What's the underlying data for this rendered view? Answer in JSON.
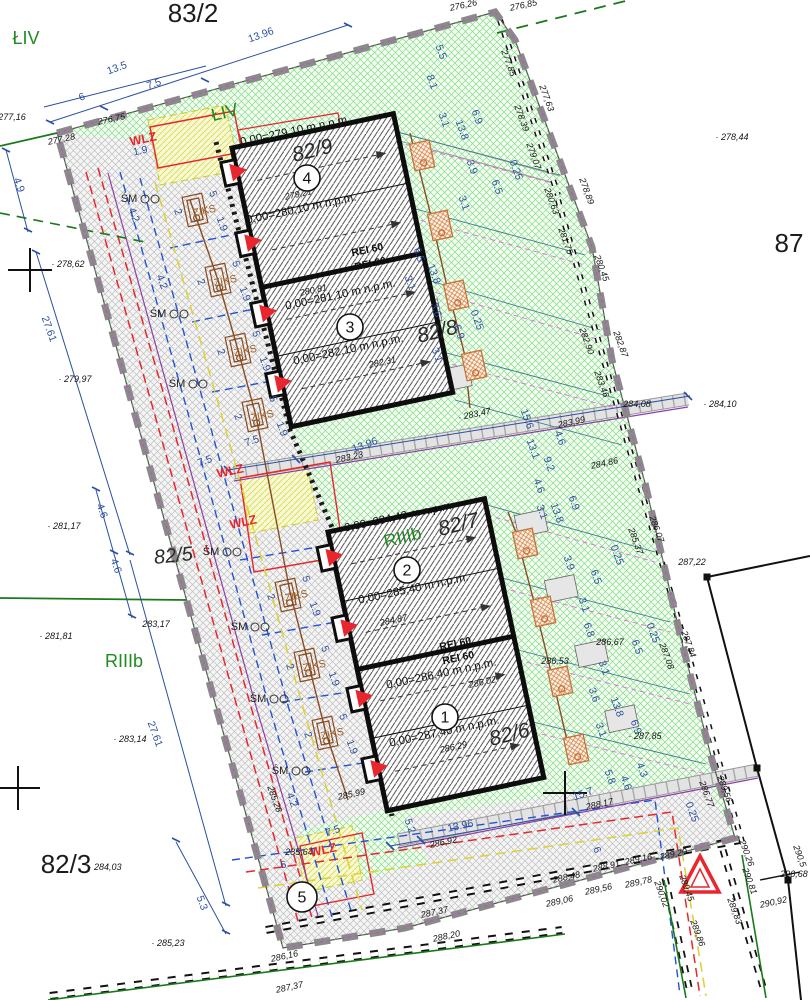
{
  "drawing_type": "site development plan",
  "parcels": [
    {
      "label": "83/2",
      "x": 193,
      "y": 22,
      "rot": 0,
      "size": 26,
      "it": false
    },
    {
      "label": "82/9",
      "x": 314,
      "y": 157,
      "rot": -14,
      "size": 21,
      "it": true
    },
    {
      "label": "82/8",
      "x": 439,
      "y": 338,
      "rot": -14,
      "size": 21,
      "it": true
    },
    {
      "label": "87",
      "x": 789,
      "y": 252,
      "rot": 0,
      "size": 26,
      "it": false
    },
    {
      "label": "82/7",
      "x": 460,
      "y": 531,
      "rot": -14,
      "size": 21,
      "it": true
    },
    {
      "label": "82/6",
      "x": 511,
      "y": 741,
      "rot": -14,
      "size": 21,
      "it": true
    },
    {
      "label": "82/5",
      "x": 174,
      "y": 562,
      "rot": -6,
      "size": 20,
      "it": true
    },
    {
      "label": "82/3",
      "x": 66,
      "y": 873,
      "rot": 0,
      "size": 26,
      "it": false
    }
  ],
  "soil": [
    {
      "t": "ŁIV",
      "x": 26,
      "y": 44,
      "rot": 0
    },
    {
      "t": "ŁIV",
      "x": 226,
      "y": 118,
      "rot": -14
    },
    {
      "t": "RIIIb",
      "x": 124,
      "y": 667,
      "rot": 0
    },
    {
      "t": "RIIIb",
      "x": 404,
      "y": 543,
      "rot": -14
    }
  ],
  "building_numbers": [
    {
      "n": "4",
      "x": 307,
      "y": 178
    },
    {
      "n": "3",
      "x": 350,
      "y": 327
    },
    {
      "n": "2",
      "x": 407,
      "y": 570
    },
    {
      "n": "1",
      "x": 445,
      "y": 717
    },
    {
      "n": "5",
      "x": 302,
      "y": 897
    }
  ],
  "levels": [
    {
      "t": "0,00=279,10 m n.p.m.",
      "x": 296,
      "y": 134,
      "rot": -12
    },
    {
      "t": "0,00=280,10 m n.p.m.",
      "x": 302,
      "y": 212,
      "rot": -12
    },
    {
      "t": "0,00=281,10 m n.p.m.",
      "x": 341,
      "y": 298,
      "rot": -12
    },
    {
      "t": "0,00=282,10 m n.p.m.",
      "x": 349,
      "y": 353,
      "rot": -12
    },
    {
      "t": "0,00=284,40 m n.p.m.",
      "x": 400,
      "y": 520,
      "rot": -12
    },
    {
      "t": "0,00=285,40 m n.p.m.",
      "x": 414,
      "y": 592,
      "rot": -12
    },
    {
      "t": "0,00=286,40 m n.p.m.",
      "x": 442,
      "y": 677,
      "rot": -12
    },
    {
      "t": "0,00=287,40 m n.p.m.",
      "x": 445,
      "y": 735,
      "rot": -12
    }
  ],
  "fire_walls": [
    {
      "t": "REI 60",
      "x": 368,
      "y": 253,
      "rot": -12
    },
    {
      "t": "REI 60",
      "x": 371,
      "y": 267,
      "rot": -12
    },
    {
      "t": "REI 60",
      "x": 456,
      "y": 647,
      "rot": -12
    },
    {
      "t": "REI 60",
      "x": 459,
      "y": 661,
      "rot": -12
    }
  ],
  "utilities": {
    "wlz": [
      {
        "t": "WLZ",
        "x": 144,
        "y": 143,
        "rot": -12
      },
      {
        "t": "WLZ",
        "x": 231,
        "y": 475,
        "rot": -12
      },
      {
        "t": "WLZ",
        "x": 244,
        "y": 526,
        "rot": -12
      },
      {
        "t": "WLZ",
        "x": 324,
        "y": 854,
        "rot": -12
      }
    ],
    "sm": [
      {
        "t": "ŚM",
        "x": 129,
        "y": 202,
        "rot": 0
      },
      {
        "t": "ŚM",
        "x": 158,
        "y": 317,
        "rot": 0
      },
      {
        "t": "ŚM",
        "x": 177,
        "y": 387,
        "rot": 0
      },
      {
        "t": "ŚM",
        "x": 211,
        "y": 555,
        "rot": 0
      },
      {
        "t": "ŚM",
        "x": 239,
        "y": 630,
        "rot": 0
      },
      {
        "t": "ŚM",
        "x": 258,
        "y": 702,
        "rot": 0
      },
      {
        "t": "ŚM",
        "x": 280,
        "y": 774,
        "rot": 0
      }
    ],
    "ziks": [
      {
        "t": "ZIKS",
        "x": 205,
        "y": 214,
        "rot": -12
      },
      {
        "t": "ZIKS",
        "x": 226,
        "y": 284,
        "rot": -12
      },
      {
        "t": "ZIKS",
        "x": 246,
        "y": 354,
        "rot": -12
      },
      {
        "t": "ZIKS",
        "x": 263,
        "y": 419,
        "rot": -12
      },
      {
        "t": "ZIKS",
        "x": 297,
        "y": 599,
        "rot": -12
      },
      {
        "t": "ZIKS",
        "x": 315,
        "y": 669,
        "rot": -12
      },
      {
        "t": "ZIKS",
        "x": 333,
        "y": 737,
        "rot": -12
      }
    ]
  },
  "dims": [
    {
      "t": "6",
      "x": 83,
      "y": 100,
      "rot": -20
    },
    {
      "t": "7.5",
      "x": 155,
      "y": 87,
      "rot": -20
    },
    {
      "t": "13.5",
      "x": 118,
      "y": 71,
      "rot": -20
    },
    {
      "t": "13.96",
      "x": 262,
      "y": 38,
      "rot": -20
    },
    {
      "t": "4.9",
      "x": 16,
      "y": 186,
      "rot": 70
    },
    {
      "t": "27.61",
      "x": 46,
      "y": 330,
      "rot": 70
    },
    {
      "t": "4.6",
      "x": 99,
      "y": 512,
      "rot": 70
    },
    {
      "t": "4.6",
      "x": 113,
      "y": 567,
      "rot": 70
    },
    {
      "t": "27.61",
      "x": 152,
      "y": 735,
      "rot": 70
    },
    {
      "t": "5.3",
      "x": 199,
      "y": 904,
      "rot": 70
    },
    {
      "t": "5.5",
      "x": 438,
      "y": 53,
      "rot": 70
    },
    {
      "t": "8.1",
      "x": 429,
      "y": 83,
      "rot": 70
    },
    {
      "t": "3.1",
      "x": 441,
      "y": 121,
      "rot": 70
    },
    {
      "t": "13.8",
      "x": 459,
      "y": 131,
      "rot": 70
    },
    {
      "t": "6.9",
      "x": 474,
      "y": 118,
      "rot": 70
    },
    {
      "t": "3.9",
      "x": 469,
      "y": 168,
      "rot": 70
    },
    {
      "t": "0.25",
      "x": 513,
      "y": 171,
      "rot": 70
    },
    {
      "t": "6.5",
      "x": 494,
      "y": 188,
      "rot": 70
    },
    {
      "t": "3.1",
      "x": 461,
      "y": 204,
      "rot": 70
    },
    {
      "t": "6.5",
      "x": 416,
      "y": 256,
      "rot": 70
    },
    {
      "t": "13.8",
      "x": 431,
      "y": 275,
      "rot": 70
    },
    {
      "t": "3.1",
      "x": 407,
      "y": 284,
      "rot": 70
    },
    {
      "t": "3.6",
      "x": 433,
      "y": 311,
      "rot": 70
    },
    {
      "t": "6.9",
      "x": 456,
      "y": 333,
      "rot": 70
    },
    {
      "t": "0.25",
      "x": 474,
      "y": 321,
      "rot": 70
    },
    {
      "t": "3.1",
      "x": 434,
      "y": 356,
      "rot": 70
    },
    {
      "t": "15.6",
      "x": 524,
      "y": 420,
      "rot": 70
    },
    {
      "t": "4.6",
      "x": 557,
      "y": 439,
      "rot": 70
    },
    {
      "t": "13.1",
      "x": 530,
      "y": 450,
      "rot": 70
    },
    {
      "t": "9.2",
      "x": 546,
      "y": 465,
      "rot": 70
    },
    {
      "t": "4.6",
      "x": 536,
      "y": 487,
      "rot": 70
    },
    {
      "t": "3.1",
      "x": 539,
      "y": 513,
      "rot": 70
    },
    {
      "t": "13.8",
      "x": 554,
      "y": 514,
      "rot": 70
    },
    {
      "t": "6.9",
      "x": 571,
      "y": 504,
      "rot": 70
    },
    {
      "t": "3.9",
      "x": 566,
      "y": 564,
      "rot": 70
    },
    {
      "t": "6.5",
      "x": 593,
      "y": 578,
      "rot": 70
    },
    {
      "t": "0.25",
      "x": 614,
      "y": 556,
      "rot": 70
    },
    {
      "t": "3.1",
      "x": 581,
      "y": 606,
      "rot": 70
    },
    {
      "t": "6.8",
      "x": 586,
      "y": 631,
      "rot": 70
    },
    {
      "t": "6.5",
      "x": 634,
      "y": 648,
      "rot": 70
    },
    {
      "t": "0.25",
      "x": 650,
      "y": 634,
      "rot": 70
    },
    {
      "t": "3.1",
      "x": 601,
      "y": 669,
      "rot": 70
    },
    {
      "t": "3.6",
      "x": 591,
      "y": 696,
      "rot": 70
    },
    {
      "t": "13.8",
      "x": 614,
      "y": 708,
      "rot": 70
    },
    {
      "t": "6.9",
      "x": 633,
      "y": 728,
      "rot": 70
    },
    {
      "t": "3.1",
      "x": 598,
      "y": 731,
      "rot": 70
    },
    {
      "t": "4.3",
      "x": 639,
      "y": 771,
      "rot": 70
    },
    {
      "t": "4.6",
      "x": 623,
      "y": 784,
      "rot": 70
    },
    {
      "t": "5.8",
      "x": 607,
      "y": 778,
      "rot": 70
    },
    {
      "t": "6",
      "x": 594,
      "y": 851,
      "rot": 70
    },
    {
      "t": "0.25",
      "x": 689,
      "y": 813,
      "rot": 70
    },
    {
      "t": "15.7",
      "x": 584,
      "y": 797,
      "rot": -20
    },
    {
      "t": "5.2",
      "x": 407,
      "y": 827,
      "rot": 70
    },
    {
      "t": "13.96",
      "x": 461,
      "y": 829,
      "rot": -12
    },
    {
      "t": "7.5",
      "x": 334,
      "y": 834,
      "rot": -20
    },
    {
      "t": "6",
      "x": 284,
      "y": 868,
      "rot": -12
    },
    {
      "t": "7.5",
      "x": 253,
      "y": 444,
      "rot": -20
    },
    {
      "t": "13.96",
      "x": 366,
      "y": 448,
      "rot": -20
    },
    {
      "t": "7.5",
      "x": 206,
      "y": 464,
      "rot": -20
    },
    {
      "t": "1.9",
      "x": 141,
      "y": 154,
      "rot": -12
    },
    {
      "t": "4.2",
      "x": 131,
      "y": 216,
      "rot": 70
    },
    {
      "t": "4.2",
      "x": 159,
      "y": 283,
      "rot": 70
    },
    {
      "t": "4.2",
      "x": 289,
      "y": 801,
      "rot": 70
    },
    {
      "t": "2",
      "x": 175,
      "y": 213,
      "rot": 70
    },
    {
      "t": "5",
      "x": 210,
      "y": 195,
      "rot": 70
    },
    {
      "t": "1.9",
      "x": 219,
      "y": 225,
      "rot": 70
    },
    {
      "t": "2",
      "x": 198,
      "y": 283,
      "rot": 70
    },
    {
      "t": "5",
      "x": 233,
      "y": 265,
      "rot": 70
    },
    {
      "t": "1.9",
      "x": 242,
      "y": 295,
      "rot": 70
    },
    {
      "t": "2",
      "x": 218,
      "y": 353,
      "rot": 70
    },
    {
      "t": "5",
      "x": 253,
      "y": 335,
      "rot": 70
    },
    {
      "t": "1.9",
      "x": 262,
      "y": 365,
      "rot": 70
    },
    {
      "t": "2",
      "x": 235,
      "y": 418,
      "rot": 70
    },
    {
      "t": "5",
      "x": 270,
      "y": 400,
      "rot": 70
    },
    {
      "t": "1.9",
      "x": 279,
      "y": 430,
      "rot": 70
    },
    {
      "t": "2",
      "x": 268,
      "y": 598,
      "rot": 70
    },
    {
      "t": "5",
      "x": 303,
      "y": 580,
      "rot": 70
    },
    {
      "t": "1.9",
      "x": 312,
      "y": 610,
      "rot": 70
    },
    {
      "t": "2",
      "x": 287,
      "y": 668,
      "rot": 70
    },
    {
      "t": "5",
      "x": 322,
      "y": 650,
      "rot": 70
    },
    {
      "t": "1.9",
      "x": 331,
      "y": 680,
      "rot": 70
    },
    {
      "t": "2",
      "x": 305,
      "y": 736,
      "rot": 70
    },
    {
      "t": "5",
      "x": 340,
      "y": 718,
      "rot": 70
    },
    {
      "t": "1.9",
      "x": 349,
      "y": 748,
      "rot": 70
    }
  ],
  "elevations": [
    {
      "t": "277,16",
      "x": 12,
      "y": 120,
      "rot": 0
    },
    {
      "t": "277,28",
      "x": 62,
      "y": 142,
      "rot": -12
    },
    {
      "t": "276,75",
      "x": 112,
      "y": 122,
      "rot": -12
    },
    {
      "t": "276,26",
      "x": 464,
      "y": 8,
      "rot": -12
    },
    {
      "t": "276,85",
      "x": 524,
      "y": 8,
      "rot": -12
    },
    {
      "t": "· 278,62",
      "x": 68,
      "y": 267,
      "rot": 0
    },
    {
      "t": "· 278,44",
      "x": 732,
      "y": 140,
      "rot": 0
    },
    {
      "t": "· 279,97",
      "x": 75,
      "y": 382,
      "rot": 0
    },
    {
      "t": "· 281,17",
      "x": 64,
      "y": 529,
      "rot": 0
    },
    {
      "t": "· 281,81",
      "x": 56,
      "y": 639,
      "rot": 0
    },
    {
      "t": "283,17",
      "x": 156,
      "y": 627,
      "rot": 0
    },
    {
      "t": "· 283,14",
      "x": 130,
      "y": 742,
      "rot": 0
    },
    {
      "t": "· 284,03",
      "x": 105,
      "y": 870,
      "rot": 0
    },
    {
      "t": "· 285,23",
      "x": 168,
      "y": 946,
      "rot": 0
    },
    {
      "t": "277,85",
      "x": 506,
      "y": 64,
      "rot": 70
    },
    {
      "t": "277,63",
      "x": 544,
      "y": 99,
      "rot": 70
    },
    {
      "t": "278,39",
      "x": 519,
      "y": 119,
      "rot": 70
    },
    {
      "t": "279,07",
      "x": 531,
      "y": 157,
      "rot": 70
    },
    {
      "t": "280,63",
      "x": 549,
      "y": 202,
      "rot": 70
    },
    {
      "t": "278,89",
      "x": 584,
      "y": 192,
      "rot": 70
    },
    {
      "t": "281,75",
      "x": 563,
      "y": 242,
      "rot": 70
    },
    {
      "t": "280,45",
      "x": 599,
      "y": 269,
      "rot": 70
    },
    {
      "t": "282,90",
      "x": 584,
      "y": 342,
      "rot": 70
    },
    {
      "t": "282,87",
      "x": 618,
      "y": 345,
      "rot": 70
    },
    {
      "t": "283,46",
      "x": 599,
      "y": 385,
      "rot": 70
    },
    {
      "t": "284,08",
      "x": 637,
      "y": 407,
      "rot": 0
    },
    {
      "t": "· 284,10",
      "x": 720,
      "y": 407,
      "rot": 0
    },
    {
      "t": "287,22",
      "x": 692,
      "y": 565,
      "rot": 0
    },
    {
      "t": "· 283,47",
      "x": 475,
      "y": 417,
      "rot": -12
    },
    {
      "t": "283,99",
      "x": 572,
      "y": 425,
      "rot": -12
    },
    {
      "t": "284,86",
      "x": 605,
      "y": 466,
      "rot": -12
    },
    {
      "t": "283,23",
      "x": 350,
      "y": 460,
      "rot": -12
    },
    {
      "t": "285,37",
      "x": 633,
      "y": 542,
      "rot": 70
    },
    {
      "t": "286,07",
      "x": 654,
      "y": 530,
      "rot": 70
    },
    {
      "t": "286,67",
      "x": 610,
      "y": 645,
      "rot": 0
    },
    {
      "t": "287,08",
      "x": 664,
      "y": 657,
      "rot": 70
    },
    {
      "t": "287,84",
      "x": 686,
      "y": 645,
      "rot": 70
    },
    {
      "t": "286,53",
      "x": 555,
      "y": 664,
      "rot": 0
    },
    {
      "t": "· 287,85",
      "x": 645,
      "y": 739,
      "rot": 0
    },
    {
      "t": "279,21",
      "x": 299,
      "y": 197,
      "rot": -12
    },
    {
      "t": "280,81",
      "x": 314,
      "y": 293,
      "rot": -12
    },
    {
      "t": "282,31",
      "x": 383,
      "y": 365,
      "rot": -12
    },
    {
      "t": "284,87",
      "x": 394,
      "y": 623,
      "rot": -12
    },
    {
      "t": "286,02",
      "x": 483,
      "y": 685,
      "rot": -12
    },
    {
      "t": "286,29",
      "x": 454,
      "y": 750,
      "rot": -12
    },
    {
      "t": "285,99",
      "x": 352,
      "y": 797,
      "rot": -12
    },
    {
      "t": "285,64",
      "x": 299,
      "y": 855,
      "rot": 0
    },
    {
      "t": "285,28",
      "x": 272,
      "y": 800,
      "rot": 70
    },
    {
      "t": "286,92",
      "x": 444,
      "y": 845,
      "rot": -12
    },
    {
      "t": "288,17",
      "x": 600,
      "y": 807,
      "rot": -12
    },
    {
      "t": "286,16",
      "x": 285,
      "y": 959,
      "rot": -12
    },
    {
      "t": "287,37",
      "x": 290,
      "y": 990,
      "rot": -12
    },
    {
      "t": "287,37",
      "x": 435,
      "y": 915,
      "rot": -12
    },
    {
      "t": "288,20",
      "x": 447,
      "y": 939,
      "rot": -12
    },
    {
      "t": "289,06",
      "x": 560,
      "y": 904,
      "rot": -12
    },
    {
      "t": "289,56",
      "x": 599,
      "y": 892,
      "rot": -12
    },
    {
      "t": "288,48",
      "x": 567,
      "y": 880,
      "rot": -12
    },
    {
      "t": "288,91",
      "x": 607,
      "y": 869,
      "rot": -12
    },
    {
      "t": "289,16",
      "x": 639,
      "y": 862,
      "rot": -12
    },
    {
      "t": "289,20",
      "x": 674,
      "y": 857,
      "rot": -12
    },
    {
      "t": "289,78",
      "x": 639,
      "y": 885,
      "rot": -12
    },
    {
      "t": "290,02",
      "x": 659,
      "y": 895,
      "rot": 70
    },
    {
      "t": "289,45",
      "x": 684,
      "y": 889,
      "rot": 70
    },
    {
      "t": "289,86",
      "x": 695,
      "y": 934,
      "rot": 70
    },
    {
      "t": "289,56",
      "x": 722,
      "y": 790,
      "rot": 70
    },
    {
      "t": "286,77",
      "x": 704,
      "y": 795,
      "rot": 70
    },
    {
      "t": "290,26",
      "x": 744,
      "y": 854,
      "rot": 70
    },
    {
      "t": "290,81",
      "x": 747,
      "y": 882,
      "rot": 70
    },
    {
      "t": "289,83",
      "x": 732,
      "y": 912,
      "rot": 70
    },
    {
      "t": "290,92",
      "x": 774,
      "y": 905,
      "rot": -12
    },
    {
      "t": "290,5",
      "x": 797,
      "y": 857,
      "rot": 70
    },
    {
      "t": "290,68",
      "x": 794,
      "y": 877,
      "rot": 0
    }
  ],
  "colors": {
    "boundary_gray": "#8a8a8a",
    "green_hatch": "#85dd85",
    "building_outline": "#0d0d0d",
    "dim_blue": "#2b4fa0",
    "red_line": "#e8262d",
    "blue_line": "#2253d4",
    "yellow_line": "#ddd23c",
    "purple_line": "#8e3fa8",
    "brown_line": "#8a4a1f",
    "soil_green": "#1e8c1e",
    "magenta_line": "#e06ad8"
  }
}
